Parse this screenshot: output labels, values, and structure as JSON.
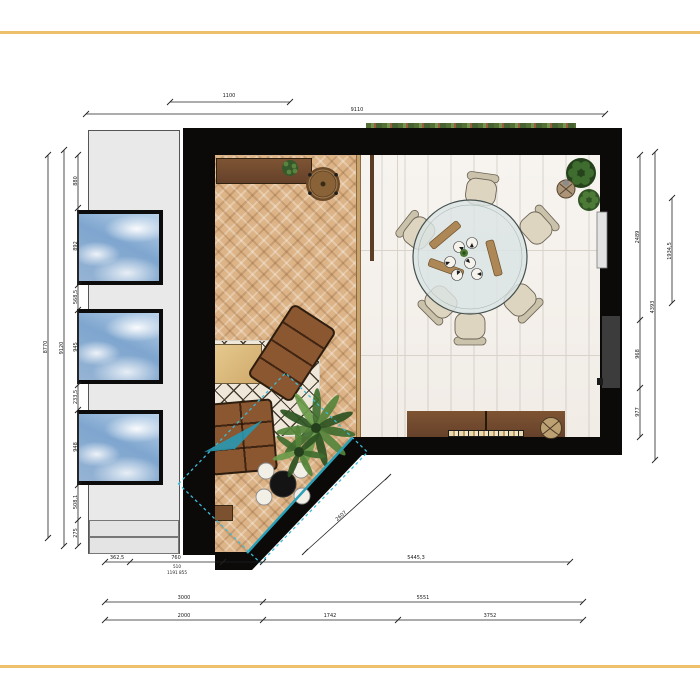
{
  "page": {
    "colors": {
      "frame_gold": "#edc06c",
      "wall": "#0b0a09",
      "accent_teal": "#2aa0b8",
      "wood_floor": "#dcb488",
      "marble_floor": "#f4f1ec",
      "corridor_gray": "#e9e9e9",
      "sofa_leather": "#8a5731",
      "sideboard_wood": "#7e5433",
      "rug_cream": "#efe8da",
      "chair_cream": "#ded5c1",
      "table_glass": "#dbe4e4",
      "plant_green": "#3f6d2f",
      "sky_blue": "#8fb4d9"
    }
  },
  "dimensions": {
    "top": [
      "1100",
      "9110"
    ],
    "left": {
      "total_outer": "8770",
      "total_inner": "9120",
      "segments": [
        "880",
        "892",
        "568,5",
        "945",
        "233,5",
        "948",
        "508,1",
        "275"
      ]
    },
    "right": {
      "segments": [
        "2489",
        "968",
        "977"
      ],
      "total": "4393",
      "window": "1934,5"
    },
    "diagonal": "2607",
    "bottom": {
      "row1": [
        "362,5",
        "760",
        "5445,3"
      ],
      "row1_sub": [
        "510",
        "1191 855"
      ],
      "row2": [
        "3000",
        "5551"
      ],
      "row3": [
        "2000",
        "1742",
        "3752"
      ]
    }
  }
}
